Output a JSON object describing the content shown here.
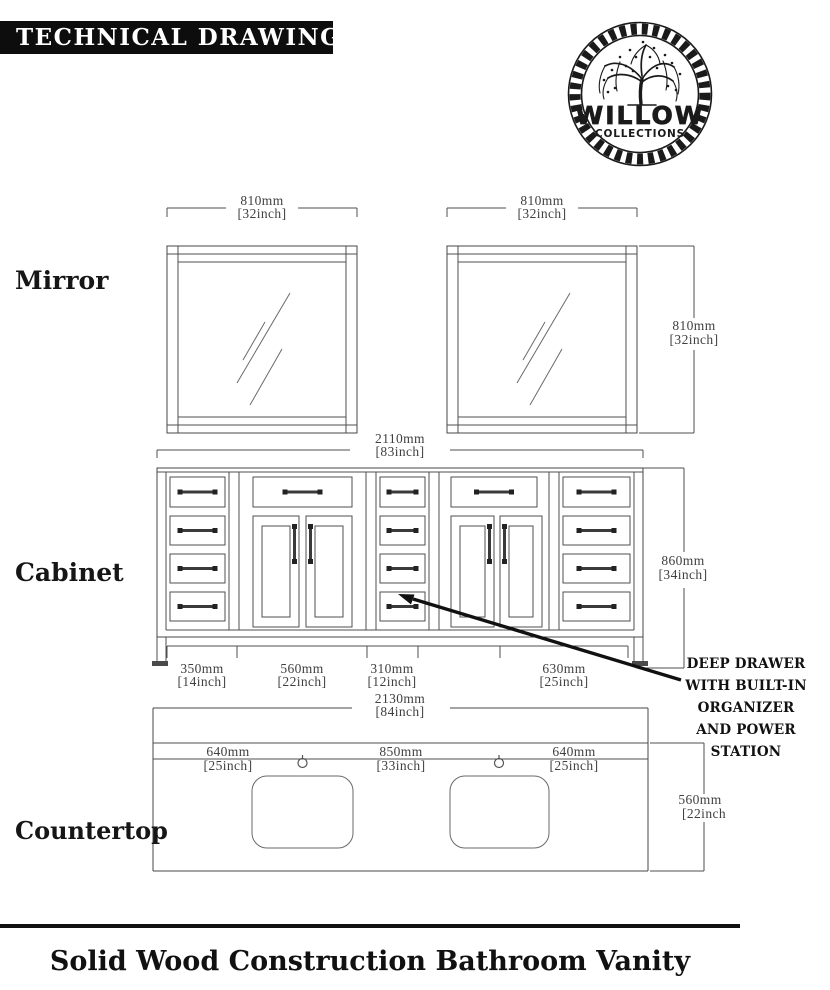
{
  "header": {
    "title": "TECHNICAL DRAWING"
  },
  "logo": {
    "brand": "WILLOW",
    "subbrand": "COLLECTIONS"
  },
  "section_labels": {
    "mirror": "Mirror",
    "cabinet": "Cabinet",
    "countertop": "Countertop"
  },
  "dims": {
    "mirror_left_width": {
      "mm": "810mm",
      "inch": "[32inch]"
    },
    "mirror_right_width": {
      "mm": "810mm",
      "inch": "[32inch]"
    },
    "mirror_height": {
      "mm": "810mm",
      "inch": "[32inch]"
    },
    "cabinet_width": {
      "mm": "2110mm",
      "inch": "[83inch]"
    },
    "cabinet_height": {
      "mm": "860mm",
      "inch": "[34inch]"
    },
    "cabinet_drawers_left": {
      "mm": "350mm",
      "inch": "[14inch]"
    },
    "cabinet_doors_left": {
      "mm": "560mm",
      "inch": "[22inch]"
    },
    "cabinet_drawers_middle": {
      "mm": "310mm",
      "inch": "[12inch]"
    },
    "cabinet_right": {
      "mm": "630mm",
      "inch": "[25inch]"
    },
    "countertop_width": {
      "mm": "2130mm",
      "inch": "[84inch]"
    },
    "countertop_left_sink": {
      "mm": "640mm",
      "inch": "[25inch]"
    },
    "countertop_center": {
      "mm": "850mm",
      "inch": "[33inch]"
    },
    "countertop_right_sink": {
      "mm": "640mm",
      "inch": "[25inch]"
    },
    "countertop_depth": {
      "mm": "560mm",
      "inch": "[22inch"
    }
  },
  "callout": {
    "line1": "DEEP DRAWER",
    "line2": "WITH BUILT-IN",
    "line3": "ORGANIZER",
    "line4": "AND POWER STATION"
  },
  "footer": {
    "caption": "Solid Wood Construction Bathroom Vanity"
  },
  "colors": {
    "line": "#4f4f4f",
    "dim_text": "#3f3f3f",
    "ink": "#111111",
    "title_bg": "#0d0d0d",
    "title_fg": "#ffffff"
  }
}
